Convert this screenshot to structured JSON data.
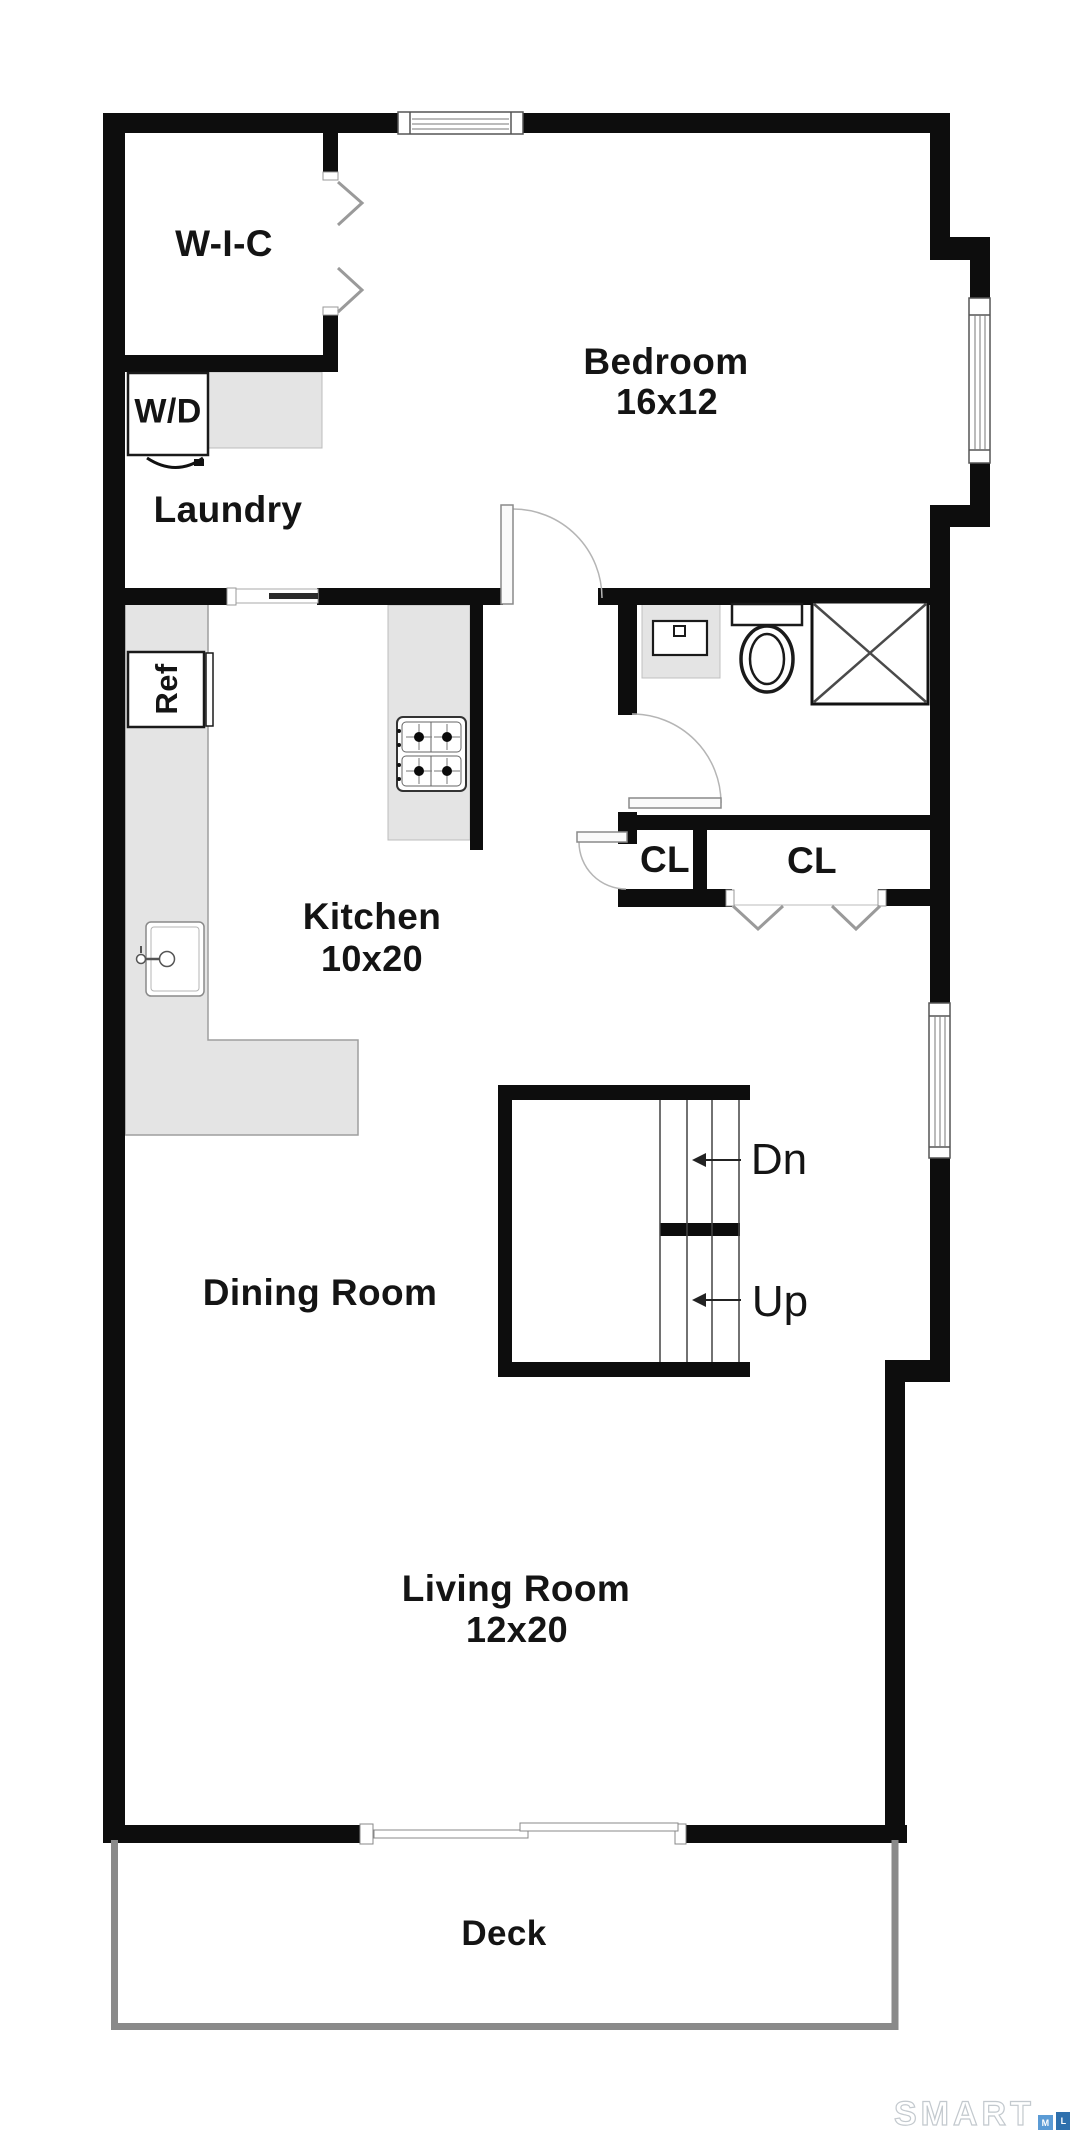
{
  "rooms": {
    "wic": {
      "label": "W-I-C"
    },
    "bedroom": {
      "label": "Bedroom",
      "dims": "16x12"
    },
    "laundry": {
      "label": "Laundry"
    },
    "kitchen": {
      "label": "Kitchen",
      "dims": "10x20"
    },
    "dining": {
      "label": "Dining Room"
    },
    "living": {
      "label": "Living Room",
      "dims": "12x20"
    },
    "deck": {
      "label": "Deck"
    },
    "closet_left": {
      "label": "CL"
    },
    "closet_right": {
      "label": "CL"
    }
  },
  "fixtures": {
    "washer_dryer": "W/D",
    "refrigerator": "Ref"
  },
  "stairs": {
    "down": "Dn",
    "up": "Up"
  },
  "watermark": {
    "brand": "SMART",
    "mls": [
      "M",
      "L",
      "S"
    ]
  },
  "colors": {
    "wall": "#0d0d0d",
    "counter": "#e4e4e4",
    "deck_border": "#8a8a8a",
    "mls_light_blue": "#5b9bd5",
    "mls_blue": "#2e70ad",
    "mls_navy": "#1c3a5e"
  }
}
